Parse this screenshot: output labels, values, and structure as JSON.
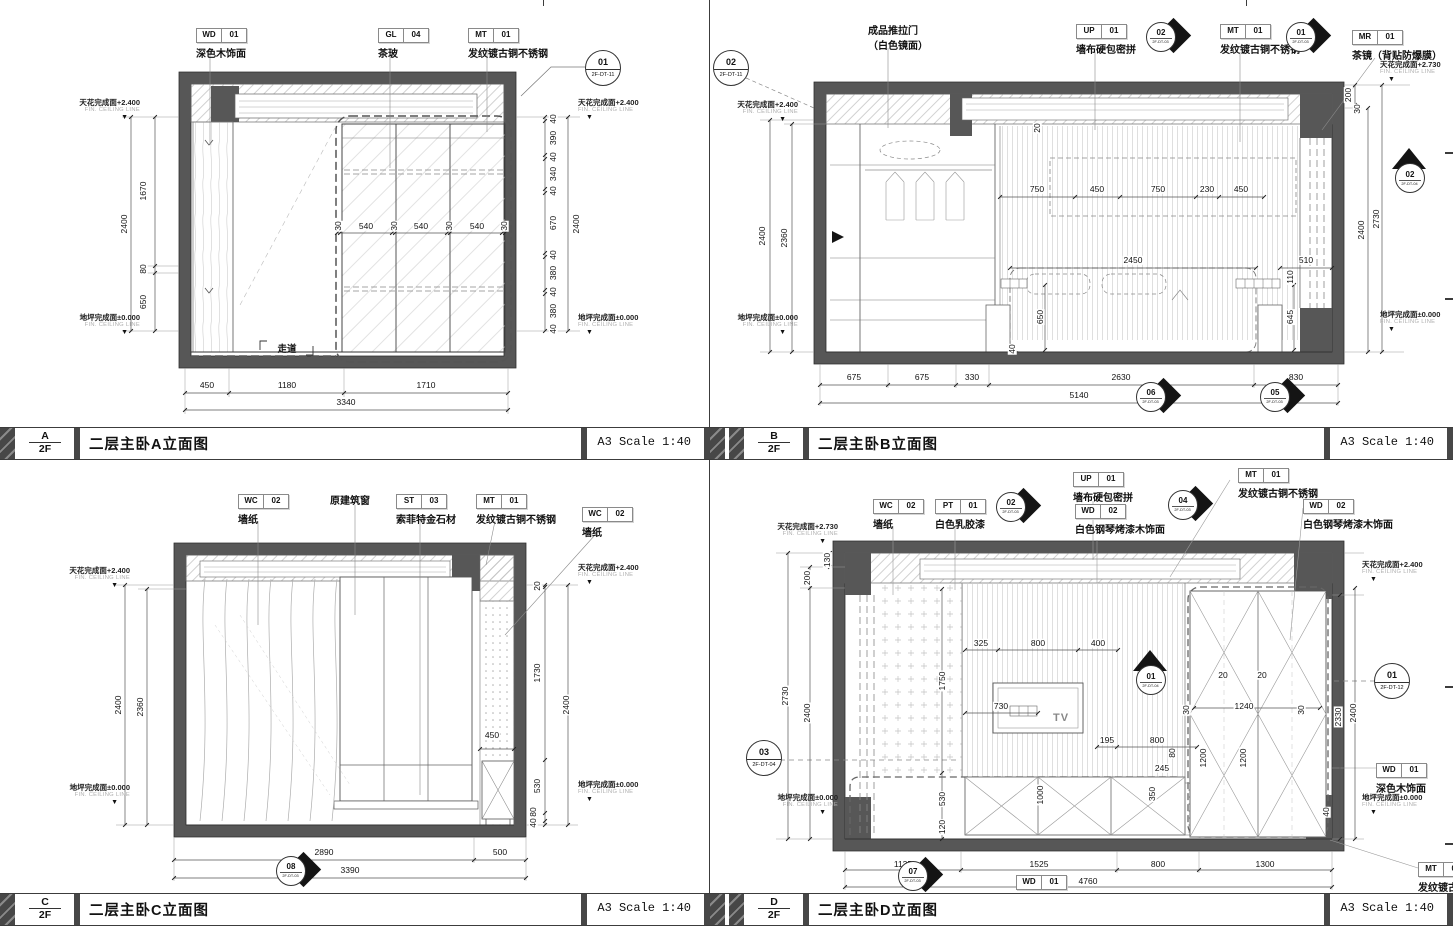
{
  "sheet": {
    "scale_label": "A3 Scale 1:40",
    "floor": "2F",
    "levels": {
      "c24": "天花完成面+2.400",
      "c27": "天花完成面+2.730",
      "fl": "地坪完成面±0.000",
      "en": "FIN. CEILING LINE"
    }
  },
  "pA": {
    "letter": "A",
    "title": "二层主卧A立面图",
    "m": [
      [
        "WD",
        "01",
        "深色木饰面"
      ],
      [
        "GL",
        "04",
        "茶玻"
      ],
      [
        "MT",
        "01",
        "发纹镀古铜不锈钢"
      ]
    ],
    "co": [
      "01",
      "2F-DT-11"
    ],
    "note": "走道",
    "dl": [
      "1670",
      "80",
      "650"
    ],
    "dlt": "2400",
    "dr": [
      "40",
      "390",
      "40",
      "340",
      "40",
      "670",
      "40",
      "380",
      "40",
      "380",
      "40"
    ],
    "drt": "2400",
    "di": [
      "30",
      "540",
      "30",
      "540",
      "30",
      "540",
      "30"
    ],
    "db": [
      "450",
      "1180",
      "1710"
    ],
    "dbt": "3340"
  },
  "pB": {
    "letter": "B",
    "title": "二层主卧B立面图",
    "m": [
      [
        "成品推拉门",
        "（白色镜面）"
      ],
      [
        "UP",
        "01",
        "墙布硬包密拼"
      ],
      [
        "MT",
        "01",
        "发纹镀古铜不锈钢"
      ],
      [
        "MR",
        "01",
        "茶镜（背贴防爆膜）"
      ]
    ],
    "co": [
      "02",
      "2F-DT-11"
    ],
    "cd": [
      [
        "02",
        "2F-DT-03"
      ],
      [
        "01",
        "2F-DT-03"
      ],
      [
        "06",
        "2F-DT-03"
      ],
      [
        "05",
        "2F-DT-03"
      ]
    ],
    "ct": [
      "02",
      "2F-DT-04"
    ],
    "dl": [
      "2400",
      "2360"
    ],
    "drtop": [
      "200",
      "30"
    ],
    "dr": [
      "2400",
      "2730"
    ],
    "dit": [
      "750",
      "450",
      "750",
      "230",
      "450"
    ],
    "di": [
      "2450",
      "510",
      "20",
      "650",
      "645",
      "110",
      "40"
    ],
    "db": [
      "675",
      "675",
      "330",
      "2630",
      "830"
    ],
    "dbt": "5140"
  },
  "pC": {
    "letter": "C",
    "title": "二层主卧C立面图",
    "m": [
      [
        "WC",
        "02",
        "墙纸"
      ],
      [
        "原建筑窗"
      ],
      [
        "ST",
        "03",
        "索菲特金石材"
      ],
      [
        "MT",
        "01",
        "发纹镀古铜不锈钢"
      ],
      [
        "WC",
        "02",
        "墙纸"
      ]
    ],
    "cd": [
      [
        "08",
        "2F-DT-03"
      ]
    ],
    "dl": [
      "2400",
      "2360"
    ],
    "dr": [
      "20",
      "1730",
      "530",
      "80",
      "40"
    ],
    "drt": "2400",
    "di": [
      "450"
    ],
    "db": [
      "2890",
      "500"
    ],
    "dbt": "3390"
  },
  "pD": {
    "letter": "D",
    "title": "二层主卧D立面图",
    "m": [
      [
        "WC",
        "02",
        "墙纸"
      ],
      [
        "PT",
        "01",
        "白色乳胶漆"
      ],
      [
        "UP",
        "01",
        "墙布硬包密拼"
      ],
      [
        "WD",
        "02",
        "白色钢琴烤漆木饰面"
      ],
      [
        "MT",
        "01",
        "发纹镀古铜不锈钢"
      ],
      [
        "WD",
        "02",
        "白色钢琴烤漆木饰面"
      ],
      [
        "WD",
        "01",
        "深色木饰面"
      ],
      [
        "WD",
        "01",
        "深色木饰面"
      ],
      [
        "MT",
        "01",
        "发纹镀古铜不锈钢"
      ]
    ],
    "cd": [
      [
        "02",
        "2F-DT-03"
      ],
      [
        "04",
        "2F-DT-03"
      ],
      [
        "07",
        "2F-DT-03"
      ]
    ],
    "ct": [
      "01",
      "2F-DT-04"
    ],
    "cc": [
      [
        "03",
        "2F-DT-04"
      ],
      [
        "01",
        "2F-DT-12"
      ]
    ],
    "tv": "TV",
    "dl": [
      "130",
      "200",
      "2730",
      "2400"
    ],
    "dit": [
      "325",
      "800",
      "400"
    ],
    "di": [
      "730",
      "195",
      "800",
      "245",
      "80",
      "350",
      "1000",
      "1750",
      "530",
      "120"
    ],
    "dw": [
      "20",
      "20",
      "1240",
      "30",
      "30",
      "1200",
      "1200"
    ],
    "dr": [
      "2330",
      "2400",
      "40"
    ],
    "db": [
      "1135",
      "1525",
      "800",
      "1300"
    ],
    "dbt": "4760"
  }
}
